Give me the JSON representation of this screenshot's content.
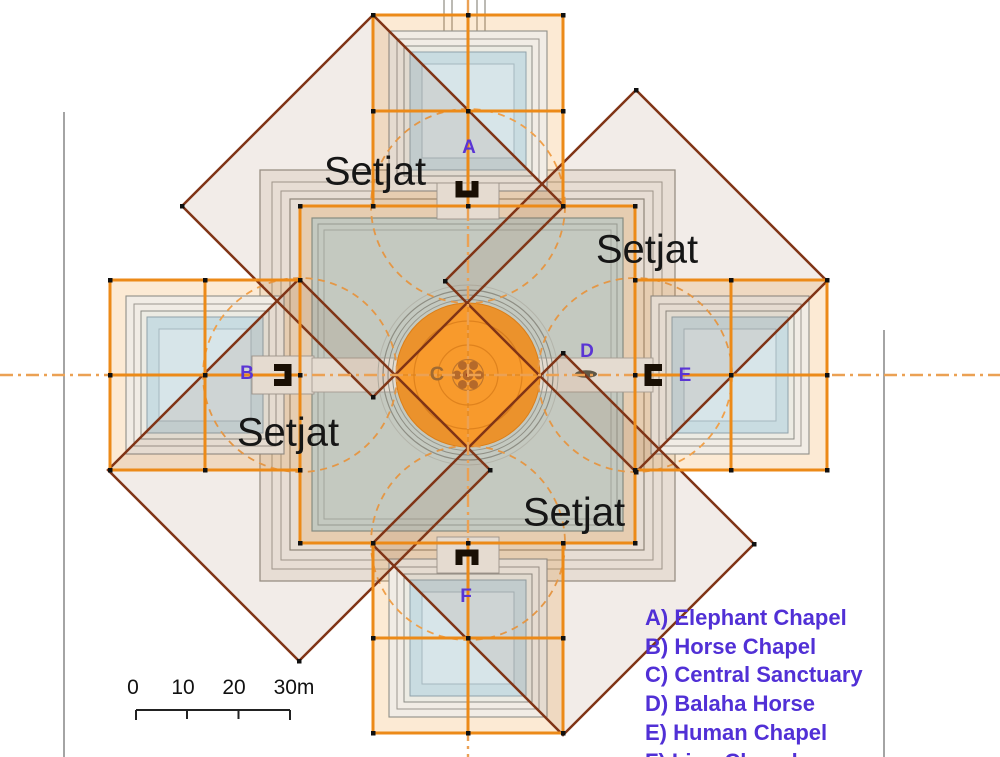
{
  "setjat_labels": {
    "top_left": "Setjat",
    "top_right": "Setjat",
    "bottom_left": "Setjat",
    "bottom_right": "Setjat"
  },
  "markers": {
    "a": "A",
    "b": "B",
    "c": "C",
    "d": "D",
    "e": "E",
    "f": "F"
  },
  "legend": {
    "items": [
      "A) Elephant Chapel",
      "B) Horse Chapel",
      "C) Central Sanctuary",
      "D) Balaha Horse",
      "E) Human Chapel",
      "F) Lion Chapel"
    ]
  },
  "scale_bar": {
    "labels": [
      "0",
      "10",
      "20",
      "30m"
    ]
  },
  "colors": {
    "grid_orange": "#ec8a18",
    "setjat_outline": "#803416",
    "setjat_fill": "rgba(140,85,50,0.11)",
    "centerline_orange": "#eba154",
    "dashed_circle_orange": "#f0a04a",
    "marker_purple": "#5a35d4",
    "legend_text": "#5130d6",
    "central_island_orange": "#f89a2c",
    "main_pool_teal": "#ccd8d2",
    "chapel_pool_blue": "#c9dce1"
  }
}
